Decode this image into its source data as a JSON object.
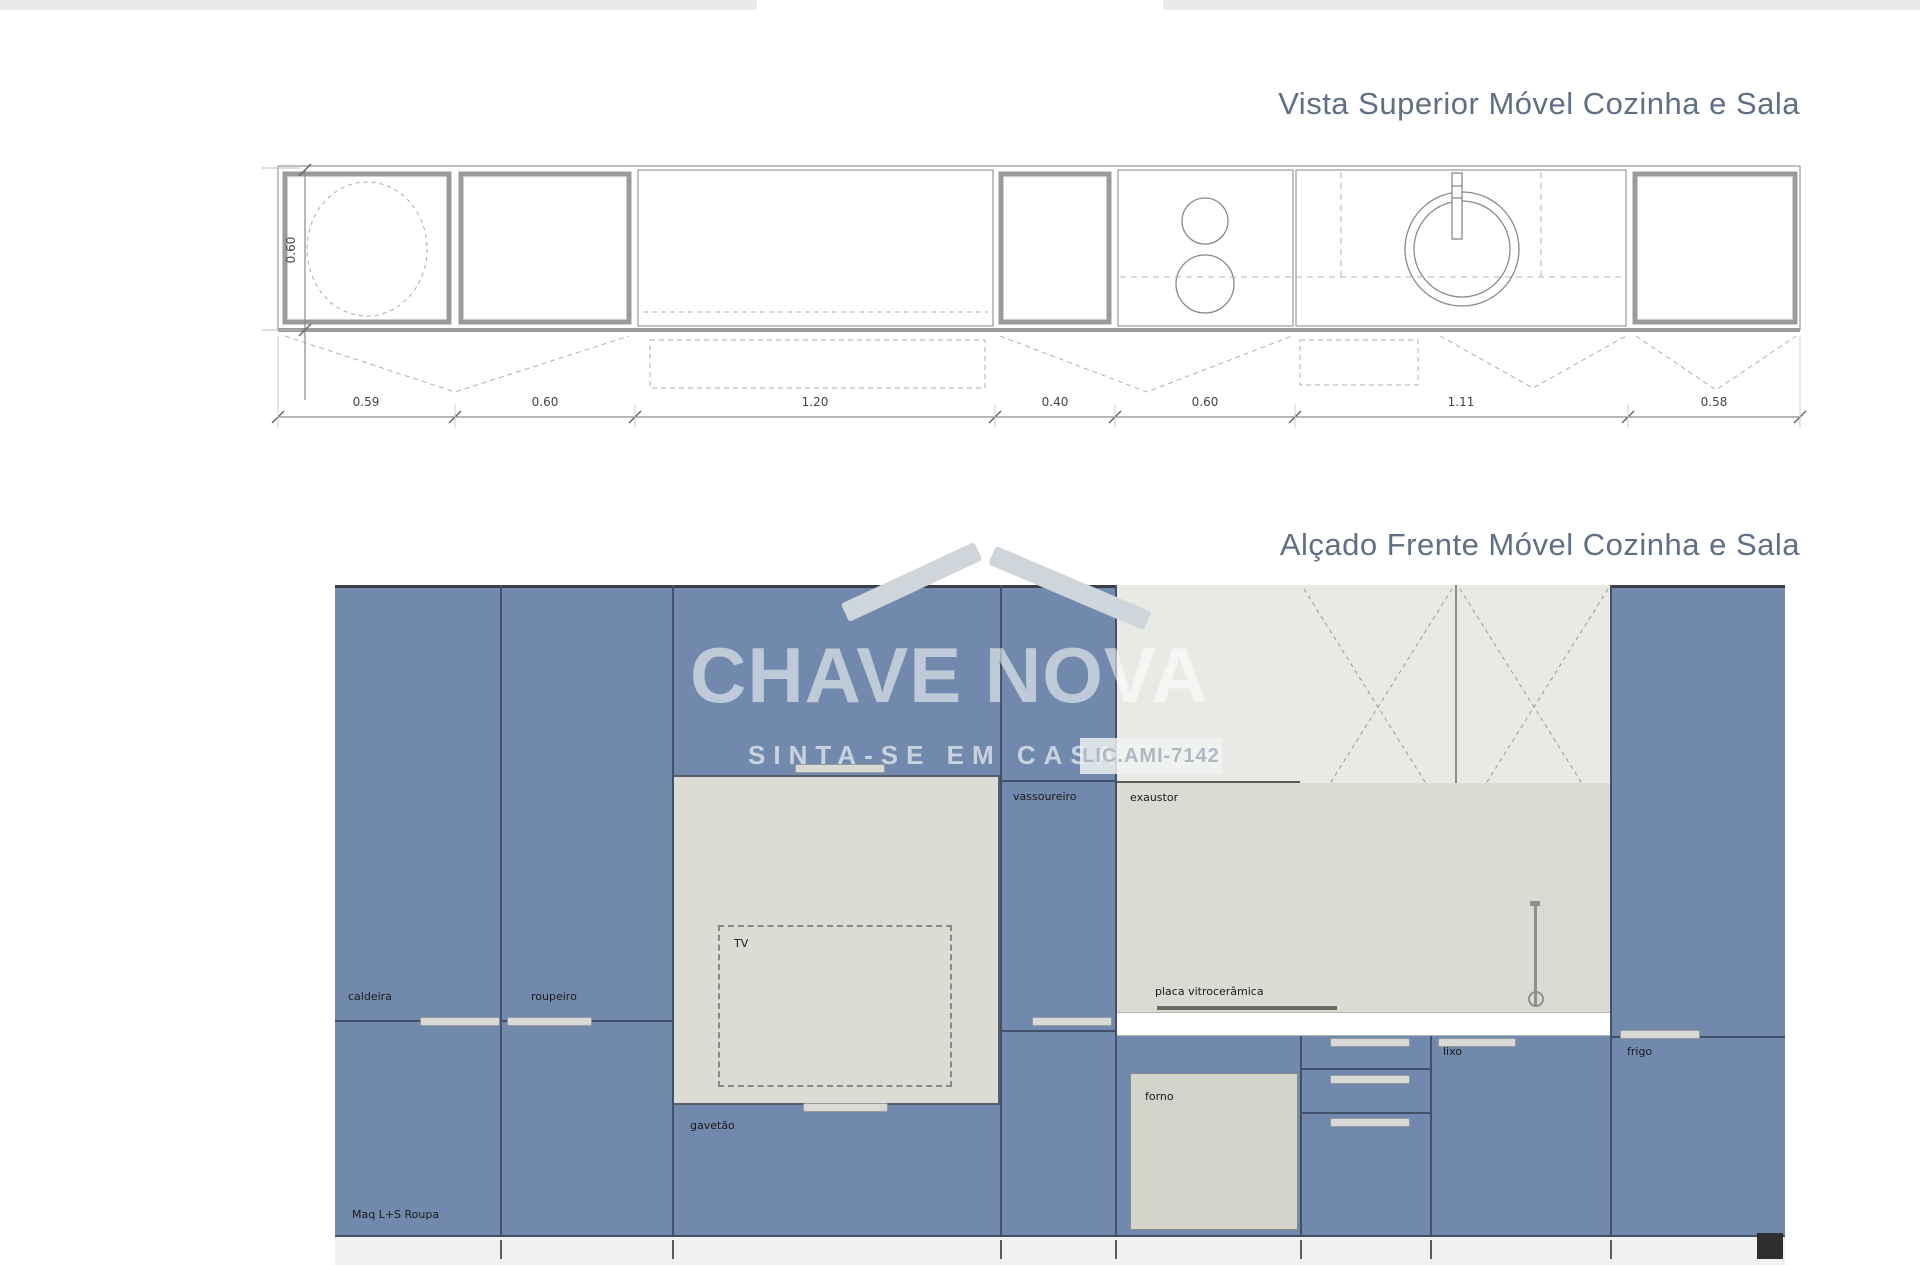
{
  "titles": {
    "plan": "Vista Superior Móvel Cozinha e Sala",
    "elevation": "Alçado Frente Móvel Cozinha e Sala"
  },
  "plan": {
    "height_dimension": "0.60",
    "dimensions": [
      "0.59",
      "0.60",
      "1.20",
      "0.40",
      "0.60",
      "1.11",
      "0.58"
    ]
  },
  "elevation": {
    "labels": {
      "caldeira": "caldeira",
      "roupeiro": "roupeiro",
      "maq_roupa": "Maq L+S Roupa",
      "tv": "TV",
      "gavetao": "gavetão",
      "vassoureiro": "vassoureiro",
      "exaustor": "exaustor",
      "placa": "placa vitrocerâmica",
      "forno": "forno",
      "lixo": "lixo",
      "frigo": "frigo"
    }
  },
  "watermark": {
    "brand": "CHAVE NOVA",
    "tagline": "SINTA-SE EM CASA",
    "license": "LIC.AMI-7142"
  },
  "colors": {
    "cabinet_blue": "#7189ac",
    "niche_gray": "#dcdcd5",
    "wall_cabinet_gray": "#e9e9e6",
    "line_dark": "#42506a",
    "title_gray_blue": "#5f7086",
    "countertop": "#ffffff"
  }
}
